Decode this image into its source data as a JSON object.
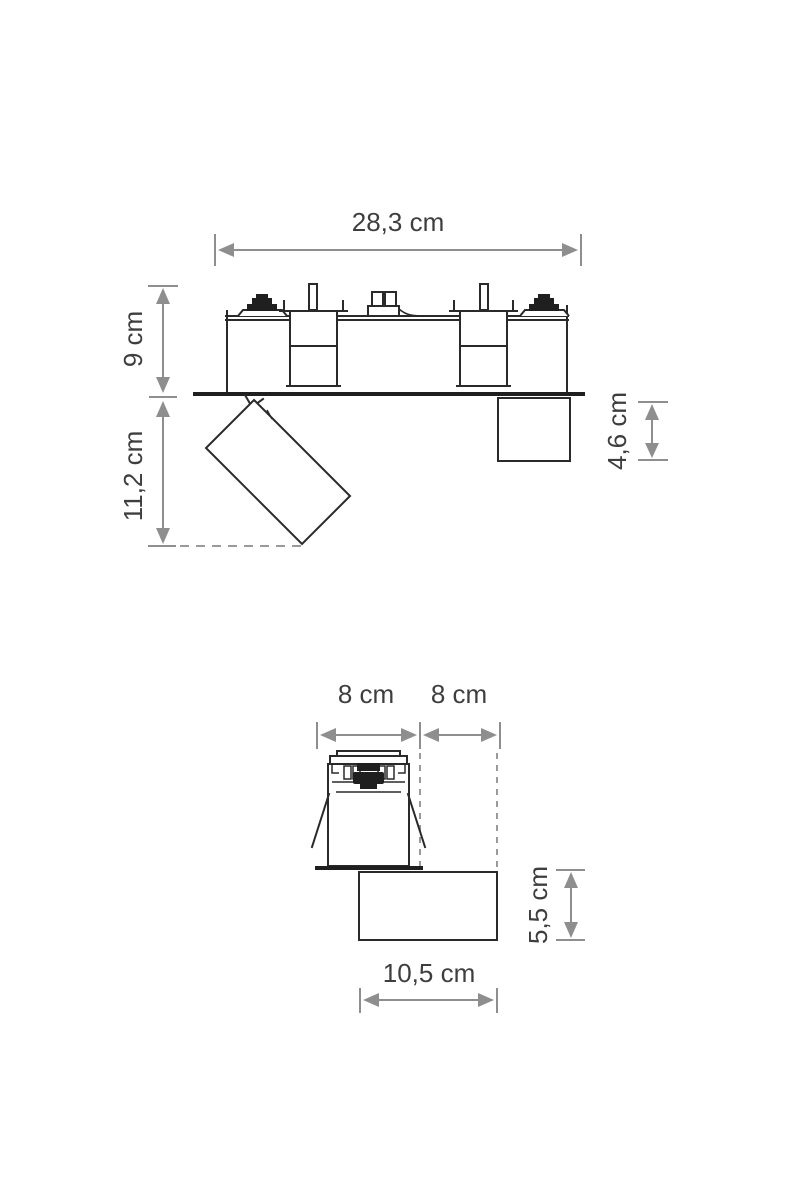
{
  "colors": {
    "outline": "#2a2a2a",
    "dimension_gray": "#8e8e8e",
    "label_text": "#3e3e3e",
    "background": "#ffffff"
  },
  "front_view": {
    "labels": {
      "overall_width": "28,3 cm",
      "housing_height": "9 cm",
      "spot_height": "11,2 cm",
      "right_box_height": "4,6 cm"
    }
  },
  "side_view": {
    "labels": {
      "head_width": "8 cm",
      "offset_width": "8 cm",
      "box_height": "5,5 cm",
      "box_width": "10,5 cm"
    }
  }
}
